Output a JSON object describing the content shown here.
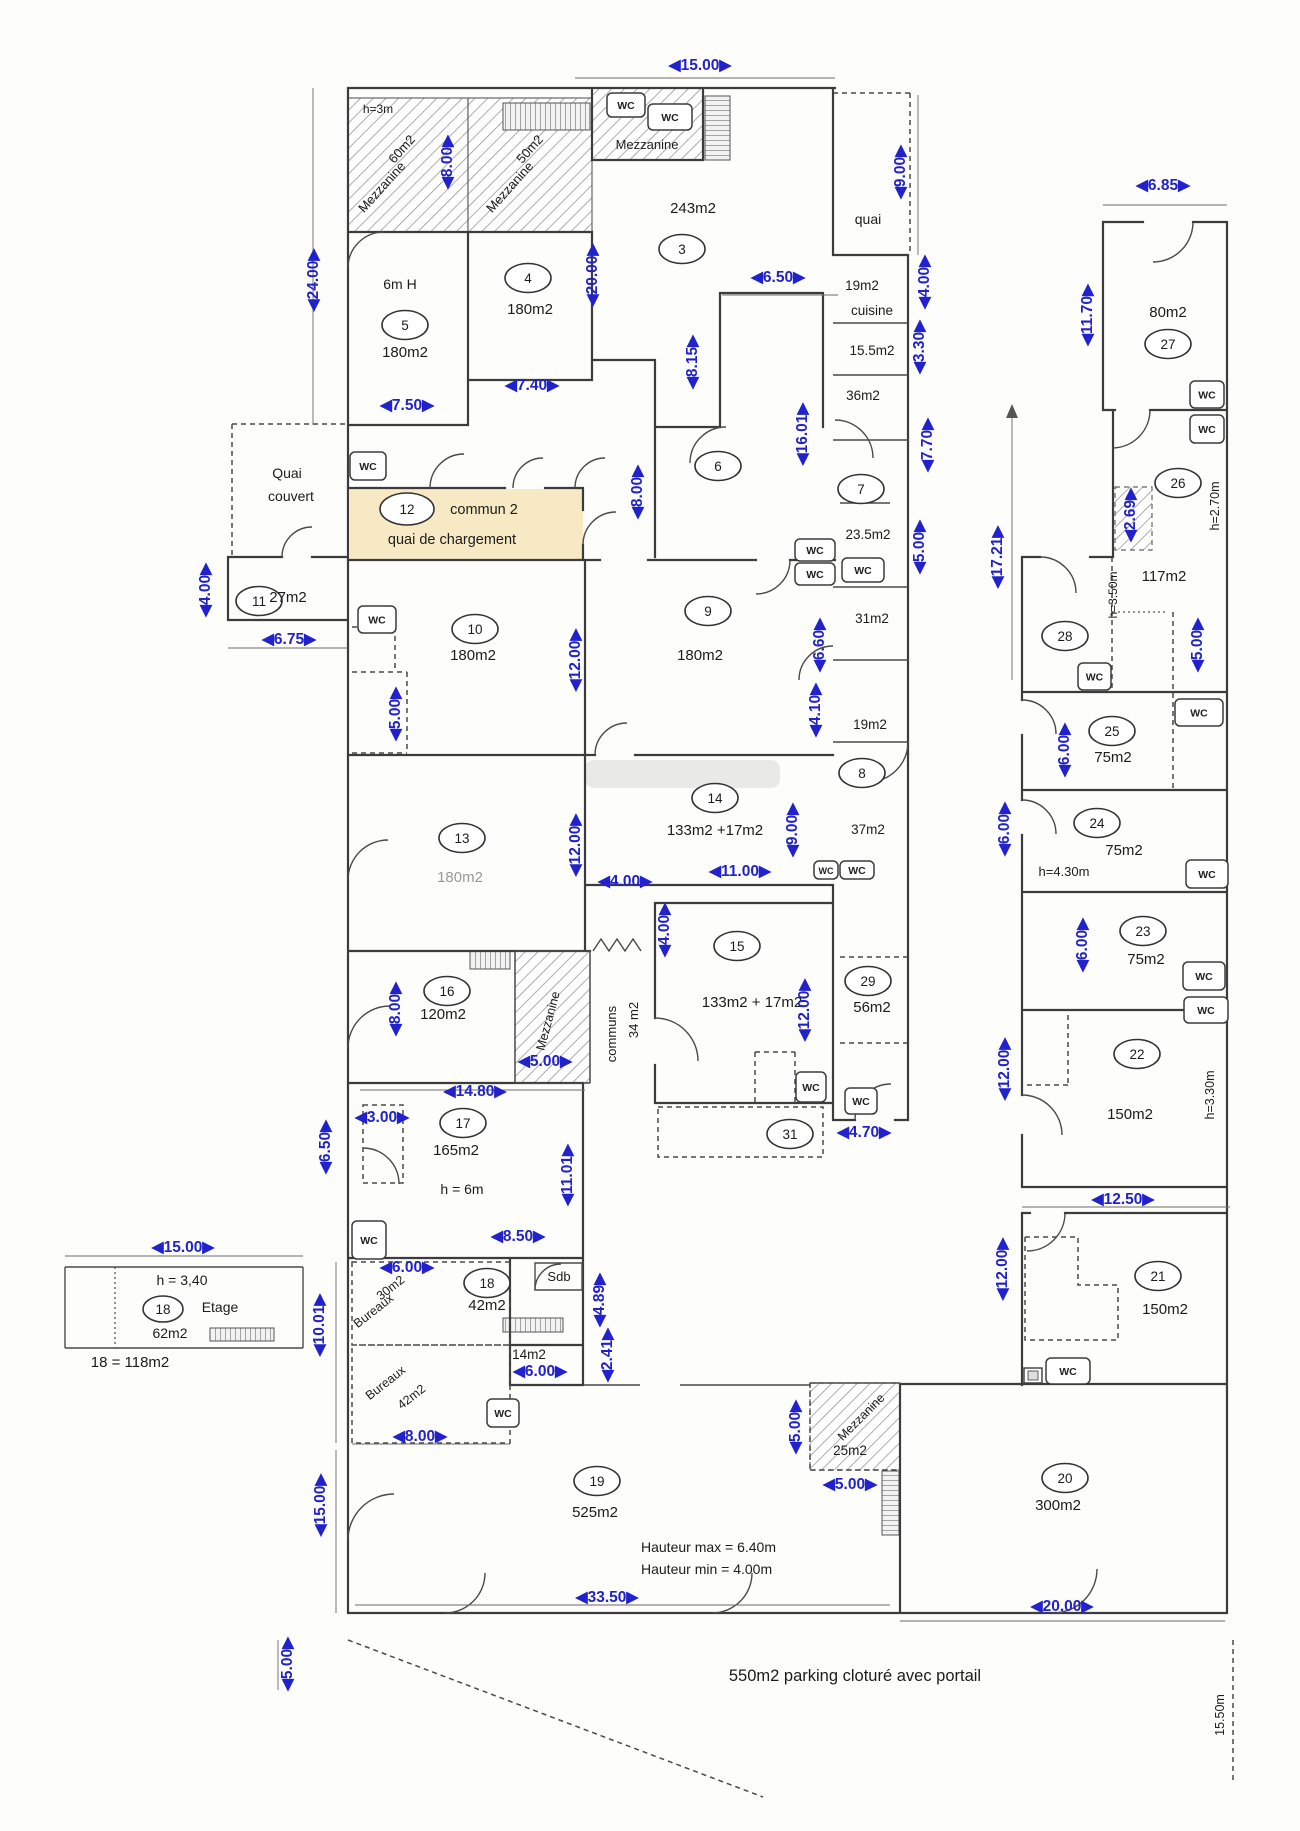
{
  "plan": {
    "arrow_left": "◀",
    "arrow_right": "▶",
    "colors": {
      "dim": "#2222cc",
      "wall": "#3c3c3c",
      "text": "#1c1c1c",
      "muted": "#999999",
      "highlight": "#f6e9c3"
    },
    "wc_label": "WC",
    "rooms": [
      {
        "n": "3",
        "x": 682,
        "y": 249
      },
      {
        "n": "4",
        "x": 528,
        "y": 278
      },
      {
        "n": "5",
        "x": 405,
        "y": 325
      },
      {
        "n": "6",
        "x": 718,
        "y": 466
      },
      {
        "n": "7",
        "x": 861,
        "y": 489
      },
      {
        "n": "8",
        "x": 862,
        "y": 773
      },
      {
        "n": "9",
        "x": 708,
        "y": 611
      },
      {
        "n": "10",
        "x": 475,
        "y": 629
      },
      {
        "n": "11",
        "x": 259,
        "y": 601
      },
      {
        "n": "12",
        "x": 407,
        "y": 509,
        "rx": 27,
        "ry": 16
      },
      {
        "n": "13",
        "x": 462,
        "y": 838
      },
      {
        "n": "14",
        "x": 715,
        "y": 798
      },
      {
        "n": "15",
        "x": 737,
        "y": 946
      },
      {
        "n": "16",
        "x": 447,
        "y": 991
      },
      {
        "n": "17",
        "x": 463,
        "y": 1123
      },
      {
        "n": "18",
        "x": 487,
        "y": 1283
      },
      {
        "n": "19",
        "x": 597,
        "y": 1481
      },
      {
        "n": "20",
        "x": 1065,
        "y": 1478
      },
      {
        "n": "21",
        "x": 1158,
        "y": 1276
      },
      {
        "n": "22",
        "x": 1137,
        "y": 1054
      },
      {
        "n": "23",
        "x": 1143,
        "y": 931
      },
      {
        "n": "24",
        "x": 1097,
        "y": 823
      },
      {
        "n": "25",
        "x": 1112,
        "y": 731
      },
      {
        "n": "26",
        "x": 1178,
        "y": 483
      },
      {
        "n": "27",
        "x": 1168,
        "y": 344
      },
      {
        "n": "28",
        "x": 1065,
        "y": 636
      },
      {
        "n": "29",
        "x": 868,
        "y": 981
      },
      {
        "n": "31",
        "x": 790,
        "y": 1134
      },
      {
        "n": "18",
        "x": 163,
        "y": 1309,
        "rx": 20,
        "ry": 13
      }
    ],
    "texts": [
      {
        "t": "h=3m",
        "x": 378,
        "y": 113,
        "s": 12
      },
      {
        "t": "60m2",
        "x": 405,
        "y": 152,
        "r": -48,
        "s": 13
      },
      {
        "t": "Mezzanine",
        "x": 385,
        "y": 190,
        "r": -48,
        "s": 13
      },
      {
        "t": "50m2",
        "x": 533,
        "y": 152,
        "r": -48,
        "s": 13
      },
      {
        "t": "Mezzanine",
        "x": 513,
        "y": 190,
        "r": -48,
        "s": 13
      },
      {
        "t": "Mezzanine",
        "x": 647,
        "y": 149,
        "s": 13
      },
      {
        "t": "243m2",
        "x": 693,
        "y": 213
      },
      {
        "t": "6m H",
        "x": 400,
        "y": 289,
        "s": 14
      },
      {
        "t": "180m2",
        "x": 405,
        "y": 357
      },
      {
        "t": "180m2",
        "x": 530,
        "y": 314
      },
      {
        "t": "quai",
        "x": 868,
        "y": 224,
        "s": 14
      },
      {
        "t": "19m2",
        "x": 862,
        "y": 290,
        "s": 13.5
      },
      {
        "t": "cuisine",
        "x": 872,
        "y": 315,
        "s": 13.5
      },
      {
        "t": "15.5m2",
        "x": 872,
        "y": 355,
        "s": 13.5
      },
      {
        "t": "36m2",
        "x": 863,
        "y": 400,
        "s": 13.5
      },
      {
        "t": "23.5m2",
        "x": 868,
        "y": 539,
        "s": 13.5
      },
      {
        "t": "31m2",
        "x": 872,
        "y": 623,
        "s": 13.5
      },
      {
        "t": "19m2",
        "x": 870,
        "y": 729,
        "s": 13.5
      },
      {
        "t": "37m2",
        "x": 868,
        "y": 834,
        "s": 13.5
      },
      {
        "t": "Quai",
        "x": 287,
        "y": 478,
        "s": 14
      },
      {
        "t": "couvert",
        "x": 291,
        "y": 501,
        "s": 14
      },
      {
        "t": "commun 2",
        "x": 484,
        "y": 514,
        "s": 14.5
      },
      {
        "t": "quai de chargement",
        "x": 452,
        "y": 544,
        "s": 14.5
      },
      {
        "t": "27m2",
        "x": 288,
        "y": 602
      },
      {
        "t": "180m2",
        "x": 473,
        "y": 660
      },
      {
        "t": "180m2",
        "x": 700,
        "y": 660
      },
      {
        "t": "180m2",
        "x": 460,
        "y": 882,
        "c": "#999999"
      },
      {
        "t": "133m2 +17m2",
        "x": 715,
        "y": 835
      },
      {
        "t": "133m2 + 17m2",
        "x": 752,
        "y": 1007
      },
      {
        "t": "communs",
        "x": 616,
        "y": 1034,
        "r": -90,
        "s": 13
      },
      {
        "t": "34 m2",
        "x": 638,
        "y": 1020,
        "r": -90,
        "s": 13
      },
      {
        "t": "56m2",
        "x": 872,
        "y": 1012
      },
      {
        "t": "120m2",
        "x": 443,
        "y": 1019
      },
      {
        "t": "Mezzanine",
        "x": 552,
        "y": 1022,
        "r": -75,
        "s": 12.5
      },
      {
        "t": "165m2",
        "x": 456,
        "y": 1155
      },
      {
        "t": "h = 6m",
        "x": 462,
        "y": 1194,
        "s": 14
      },
      {
        "t": "42m2",
        "x": 487,
        "y": 1310
      },
      {
        "t": "Sdb",
        "x": 559,
        "y": 1281,
        "s": 13
      },
      {
        "t": "14m2",
        "x": 529,
        "y": 1359,
        "s": 13.5
      },
      {
        "t": "30m2",
        "x": 393,
        "y": 1291,
        "r": -38,
        "s": 12.5
      },
      {
        "t": "Bureaux",
        "x": 376,
        "y": 1314,
        "r": -38,
        "s": 12.5
      },
      {
        "t": "Bureaux",
        "x": 388,
        "y": 1386,
        "r": -38,
        "s": 12.5
      },
      {
        "t": "42m2",
        "x": 414,
        "y": 1400,
        "r": -38,
        "s": 12.5
      },
      {
        "t": "525m2",
        "x": 595,
        "y": 1517
      },
      {
        "t": "Hauteur max = 6.40m",
        "x": 641,
        "y": 1552,
        "s": 14,
        "a": "start"
      },
      {
        "t": "Hauteur min = 4.00m",
        "x": 641,
        "y": 1574,
        "s": 14,
        "a": "start"
      },
      {
        "t": "550m2 parking cloturé avec portail",
        "x": 855,
        "y": 1681,
        "s": 16.5
      },
      {
        "t": "Mezzanine",
        "x": 864,
        "y": 1420,
        "r": -45,
        "s": 12.5
      },
      {
        "t": "25m2",
        "x": 850,
        "y": 1455,
        "s": 13.5
      },
      {
        "t": "300m2",
        "x": 1058,
        "y": 1510
      },
      {
        "t": "80m2",
        "x": 1168,
        "y": 317
      },
      {
        "t": "117m2",
        "x": 1164,
        "y": 581
      },
      {
        "t": "h=2.70m",
        "x": 1219,
        "y": 506,
        "r": -90,
        "s": 12.5
      },
      {
        "t": "h=3.50m",
        "x": 1117,
        "y": 595,
        "r": -90,
        "s": 12
      },
      {
        "t": "h=4.30m",
        "x": 1064,
        "y": 876,
        "s": 13
      },
      {
        "t": "h=3.30m",
        "x": 1214,
        "y": 1095,
        "r": -90,
        "s": 12.5
      },
      {
        "t": "75m2",
        "x": 1113,
        "y": 762
      },
      {
        "t": "75m2",
        "x": 1124,
        "y": 855
      },
      {
        "t": "75m2",
        "x": 1146,
        "y": 964
      },
      {
        "t": "150m2",
        "x": 1130,
        "y": 1119
      },
      {
        "t": "150m2",
        "x": 1165,
        "y": 1314
      },
      {
        "t": "h = 3,40",
        "x": 182,
        "y": 1285,
        "s": 14
      },
      {
        "t": "Etage",
        "x": 220,
        "y": 1312,
        "s": 14
      },
      {
        "t": "62m2",
        "x": 170,
        "y": 1338,
        "s": 14
      },
      {
        "t": "18 = 118m2",
        "x": 130,
        "y": 1367,
        "s": 15
      },
      {
        "t": "15.50m",
        "x": 1224,
        "y": 1715,
        "r": -90,
        "s": 12.5
      }
    ],
    "dims": [
      {
        "t": "15.00",
        "x": 700,
        "y": 70
      },
      {
        "t": "6.85",
        "x": 1163,
        "y": 190
      },
      {
        "t": "9.00",
        "x": 905,
        "y": 172,
        "r": -90
      },
      {
        "t": "8.00",
        "x": 452,
        "y": 162,
        "r": -90
      },
      {
        "t": "20.00",
        "x": 597,
        "y": 275,
        "r": -90
      },
      {
        "t": "24.00",
        "x": 318,
        "y": 280,
        "r": -90
      },
      {
        "t": "11.70",
        "x": 1092,
        "y": 315,
        "r": -90
      },
      {
        "t": "4.00",
        "x": 929,
        "y": 282,
        "r": -90
      },
      {
        "t": "3.30",
        "x": 924,
        "y": 347,
        "r": -90
      },
      {
        "t": "6.50",
        "x": 778,
        "y": 282
      },
      {
        "t": "8.15",
        "x": 697,
        "y": 362,
        "r": -90
      },
      {
        "t": "16.01",
        "x": 807,
        "y": 434,
        "r": -90
      },
      {
        "t": "7.70",
        "x": 932,
        "y": 445,
        "r": -90
      },
      {
        "t": "7.40",
        "x": 532,
        "y": 390
      },
      {
        "t": "7.50",
        "x": 407,
        "y": 410
      },
      {
        "t": "2.69",
        "x": 1135,
        "y": 515,
        "r": -90
      },
      {
        "t": "17.21",
        "x": 1002,
        "y": 557,
        "r": -90
      },
      {
        "t": "8.00",
        "x": 642,
        "y": 492,
        "r": -90
      },
      {
        "t": "5.00",
        "x": 924,
        "y": 547,
        "r": -90
      },
      {
        "t": "5.00",
        "x": 1202,
        "y": 645,
        "r": -90
      },
      {
        "t": "4.00",
        "x": 210,
        "y": 590,
        "r": -90
      },
      {
        "t": "6.75",
        "x": 289,
        "y": 644
      },
      {
        "t": "12.00",
        "x": 580,
        "y": 660,
        "r": -90
      },
      {
        "t": "6.60",
        "x": 824,
        "y": 645,
        "r": -90
      },
      {
        "t": "5.00",
        "x": 400,
        "y": 714,
        "r": -90
      },
      {
        "t": "4.10",
        "x": 820,
        "y": 710,
        "r": -90
      },
      {
        "t": "6.00",
        "x": 1069,
        "y": 750,
        "r": -90
      },
      {
        "t": "6.00",
        "x": 1009,
        "y": 829,
        "r": -90
      },
      {
        "t": "12.00",
        "x": 580,
        "y": 845,
        "r": -90
      },
      {
        "t": "9.00",
        "x": 797,
        "y": 830,
        "r": -90
      },
      {
        "t": "11.00",
        "x": 740,
        "y": 876
      },
      {
        "t": "4.00",
        "x": 625,
        "y": 886
      },
      {
        "t": "4.00",
        "x": 669,
        "y": 930,
        "r": -90
      },
      {
        "t": "6.00",
        "x": 1087,
        "y": 945,
        "r": -90
      },
      {
        "t": "12.00",
        "x": 809,
        "y": 1010,
        "r": -90
      },
      {
        "t": "8.00",
        "x": 400,
        "y": 1009,
        "r": -90
      },
      {
        "t": "5.00",
        "x": 545,
        "y": 1066
      },
      {
        "t": "12.00",
        "x": 1009,
        "y": 1069,
        "r": -90
      },
      {
        "t": "14.80",
        "x": 475,
        "y": 1096
      },
      {
        "t": "3.00",
        "x": 382,
        "y": 1122
      },
      {
        "t": "6.50",
        "x": 330,
        "y": 1147,
        "r": -90
      },
      {
        "t": "4.70",
        "x": 864,
        "y": 1137
      },
      {
        "t": "11.01",
        "x": 572,
        "y": 1175,
        "r": -90
      },
      {
        "t": "12.50",
        "x": 1123,
        "y": 1204
      },
      {
        "t": "8.50",
        "x": 518,
        "y": 1241
      },
      {
        "t": "15.00",
        "x": 183,
        "y": 1252
      },
      {
        "t": "6.00",
        "x": 407,
        "y": 1272
      },
      {
        "t": "12.00",
        "x": 1007,
        "y": 1269,
        "r": -90
      },
      {
        "t": "4.89",
        "x": 604,
        "y": 1300,
        "r": -90
      },
      {
        "t": "10.01",
        "x": 324,
        "y": 1325,
        "r": -90
      },
      {
        "t": "2.41",
        "x": 612,
        "y": 1355,
        "r": -90
      },
      {
        "t": "6.00",
        "x": 540,
        "y": 1376
      },
      {
        "t": "5.00",
        "x": 800,
        "y": 1427,
        "r": -90
      },
      {
        "t": "8.00",
        "x": 420,
        "y": 1441
      },
      {
        "t": "5.00",
        "x": 850,
        "y": 1489
      },
      {
        "t": "15.00",
        "x": 325,
        "y": 1505,
        "r": -90
      },
      {
        "t": "33.50",
        "x": 607,
        "y": 1602
      },
      {
        "t": "20.00",
        "x": 1062,
        "y": 1611
      },
      {
        "t": "5.00",
        "x": 292,
        "y": 1664,
        "r": -90
      }
    ],
    "wcs": [
      {
        "x": 607,
        "y": 93,
        "w": 38,
        "h": 24
      },
      {
        "x": 648,
        "y": 104,
        "w": 44,
        "h": 26
      },
      {
        "x": 350,
        "y": 452,
        "w": 36,
        "h": 28
      },
      {
        "x": 358,
        "y": 606,
        "w": 38,
        "h": 27
      },
      {
        "x": 795,
        "y": 539,
        "w": 40,
        "h": 22
      },
      {
        "x": 795,
        "y": 563,
        "w": 40,
        "h": 22
      },
      {
        "x": 842,
        "y": 558,
        "w": 42,
        "h": 24
      },
      {
        "x": 814,
        "y": 861,
        "w": 24,
        "h": 18
      },
      {
        "x": 840,
        "y": 861,
        "w": 34,
        "h": 18
      },
      {
        "x": 796,
        "y": 1072,
        "w": 30,
        "h": 30
      },
      {
        "x": 845,
        "y": 1088,
        "w": 32,
        "h": 26
      },
      {
        "x": 352,
        "y": 1221,
        "w": 34,
        "h": 38
      },
      {
        "x": 487,
        "y": 1399,
        "w": 32,
        "h": 28
      },
      {
        "x": 1190,
        "y": 381,
        "w": 34,
        "h": 27
      },
      {
        "x": 1190,
        "y": 415,
        "w": 34,
        "h": 28
      },
      {
        "x": 1078,
        "y": 663,
        "w": 33,
        "h": 27
      },
      {
        "x": 1175,
        "y": 699,
        "w": 48,
        "h": 27
      },
      {
        "x": 1186,
        "y": 860,
        "w": 42,
        "h": 28
      },
      {
        "x": 1183,
        "y": 962,
        "w": 42,
        "h": 28
      },
      {
        "x": 1184,
        "y": 997,
        "w": 44,
        "h": 26
      },
      {
        "x": 1046,
        "y": 1358,
        "w": 44,
        "h": 26
      }
    ]
  }
}
